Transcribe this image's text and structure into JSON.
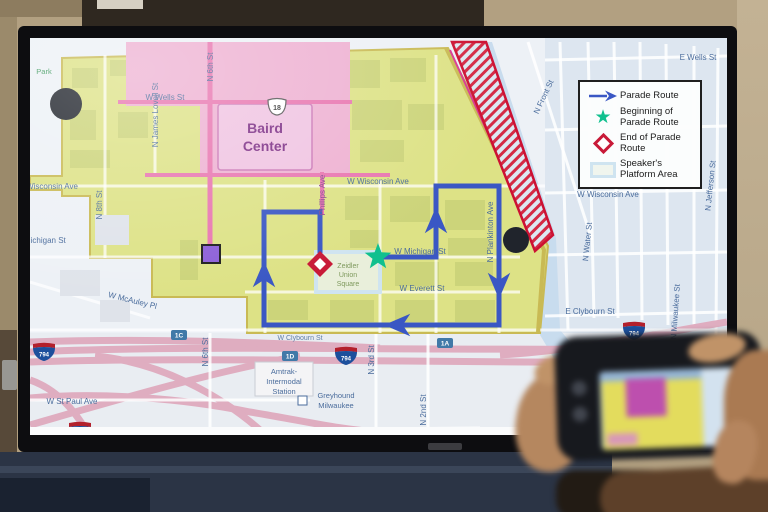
{
  "legend": {
    "items": [
      {
        "symbol": "parade-route-arrow",
        "label": "Parade Route"
      },
      {
        "symbol": "beginning-star",
        "label": "Beginning of Parade Route"
      },
      {
        "symbol": "end-diamond",
        "label": "End of Parade Route"
      },
      {
        "symbol": "platform-box",
        "label": "Speaker's Platform Area"
      }
    ]
  },
  "map": {
    "streets": {
      "e_wells": "E Wells St",
      "w_wells": "W Wells St",
      "wisconsin_left": "Wisconsin Ave",
      "wisconsin_center": "W Wisconsin Ave",
      "wisconsin_right": "W Wisconsin Ave",
      "michigan_left": "W Michigan St",
      "michigan_center": "W Michigan St",
      "everett": "W Everett St",
      "e_clybourn": "E Clybourn St",
      "w_clybourn": "W Clybourn St",
      "mcauley": "W McAuley Pl",
      "st_paul": "W St Paul Ave",
      "n_8th": "N 8th St",
      "james_lovell": "N James Lovell St",
      "n_6th_top": "N 6th St",
      "n_6th_bottom": "N 6th St",
      "phillips": "Phillips Ave",
      "n_3rd": "N 3rd St",
      "n_2nd": "N 2nd St",
      "plankinton": "N Plankinton Ave",
      "n_water": "N Water St",
      "n_front": "N Front St",
      "jefferson": "N Jefferson St",
      "n_milwaukee": "N Milwaukee St"
    },
    "places": {
      "park": "Park",
      "baird1": "Baird",
      "baird2": "Center",
      "zeidler1": "Zeidler",
      "zeidler2": "Union",
      "zeidler3": "Square",
      "amtrak1": "Amtrak-",
      "amtrak2": "Intermodal",
      "amtrak3": "Station",
      "greyhound1": "Greyhound",
      "greyhound2": "Milwaukee"
    },
    "shields": {
      "us18": "18",
      "i794": "794",
      "exit_1c": "1C",
      "exit_1d": "1D",
      "exit_1a": "1A"
    },
    "colors": {
      "parade_route": "#3a57c4",
      "beginning_marker": "#10c08e",
      "end_marker": "#c81a38",
      "platform_outline": "#cfe4f0",
      "secure_zone_yellow": "#dde286",
      "district_pink": "#eeb1d2",
      "hatch_red": "#d42a45",
      "purple_marker": "#8c5fd8"
    }
  }
}
